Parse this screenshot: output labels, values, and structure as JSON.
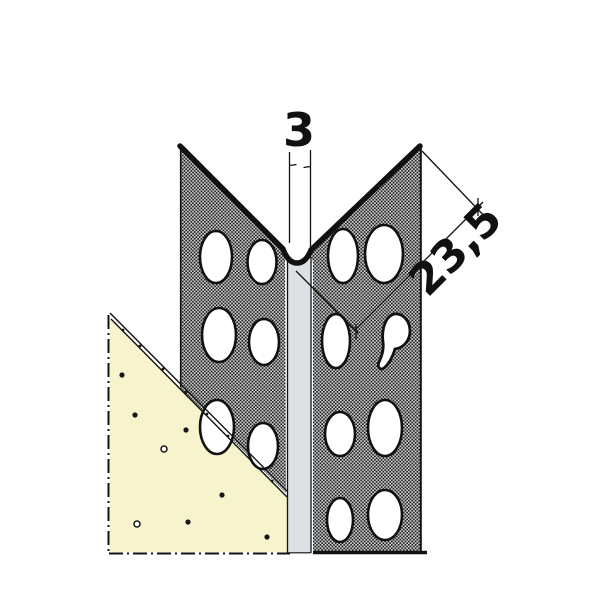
{
  "diagram": {
    "type": "technical-drawing",
    "subject": "perforated-corner-bead-profile-embedded-in-plaster",
    "dimensions": {
      "bead_width": "3",
      "flange_width": "23,5"
    },
    "colors": {
      "outline": "#111111",
      "flange_fill": "#d5d7d9",
      "flange_dot": "#161616",
      "bead_fill": "#dde0e4",
      "plaster_fill": "#f7f3cd",
      "background": "#ffffff"
    }
  }
}
